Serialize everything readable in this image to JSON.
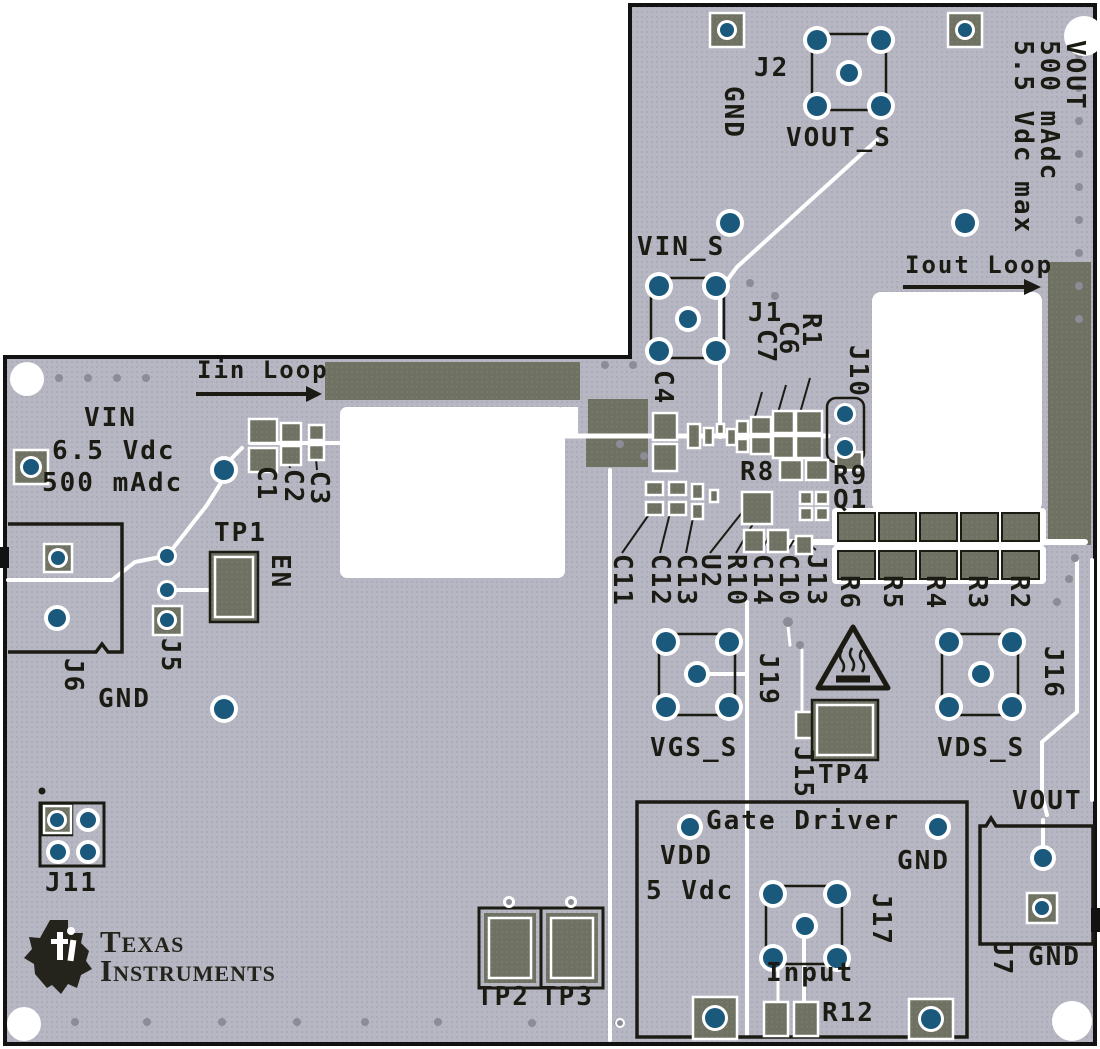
{
  "labels": {
    "iin_loop": "Iin Loop",
    "iout_loop": "Iout Loop",
    "spec_vdc": "5.5 Vdc max",
    "spec_ma": "500 mAdc",
    "spec_vout": "VOUT",
    "j2": "J2",
    "gnd_top": "GND",
    "vout_s": "VOUT_S",
    "vin_s": "VIN_S",
    "j1": "J1",
    "c7": "C7",
    "c6": "C6",
    "r1": "R1",
    "j10": "J10",
    "c4": "C4",
    "r8": "R8",
    "r9": "R9",
    "q1": "Q1",
    "vin": "VIN",
    "vin_vdc": "6.5 Vdc",
    "vin_ma": "500 mAdc",
    "c1": "C1",
    "c2": "C2",
    "c3": "C3",
    "tp1": "TP1",
    "en": "EN",
    "j5": "J5",
    "j6": "J6",
    "gnd_left": "GND",
    "j11": "J11",
    "c11": "C11",
    "c12": "C12",
    "c13": "C13",
    "u2": "U2",
    "r10": "R10",
    "c14": "C14",
    "c10": "C10",
    "j13": "J13",
    "r6": "R6",
    "r5": "R5",
    "r4": "R4",
    "r3": "R3",
    "r2": "R2",
    "vgs_s": "VGS_S",
    "j19": "J19",
    "j15": "J15",
    "tp4": "TP4",
    "vds_s": "VDS_S",
    "j16": "J16",
    "gate_driver": "Gate Driver",
    "vdd": "VDD",
    "vdd_v": "5 Vdc",
    "gnd_gd": "GND",
    "j17": "J17",
    "input": "Input",
    "r12": "R12",
    "vout": "VOUT",
    "j7": "J7",
    "gnd_out": "GND",
    "tp2": "TP2",
    "tp3": "TP3",
    "brand_1": "Texas",
    "brand_2": "Instruments"
  },
  "colors": {
    "board": "#b6b7c2",
    "board_dot": "#a7a8b4",
    "copper": "#6f7263",
    "silkscreen": "#1b1b14",
    "via_blue": "#1a587c",
    "outline": "#121212"
  }
}
